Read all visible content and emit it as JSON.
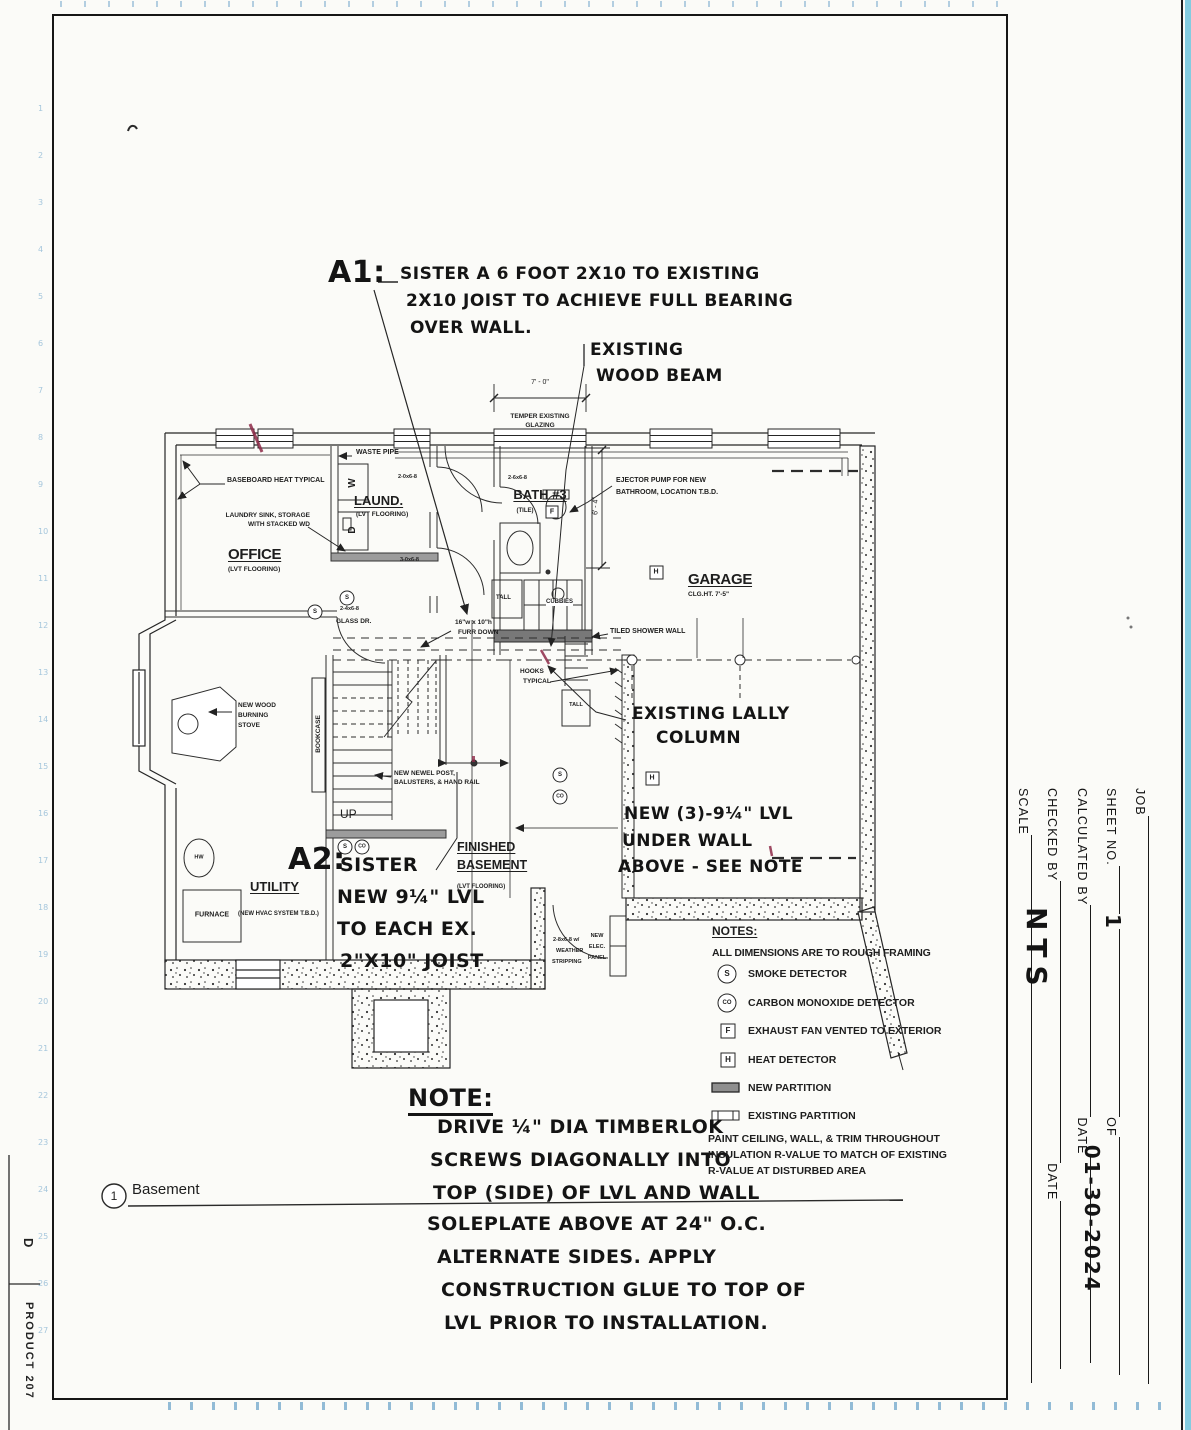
{
  "edge": {
    "letter": "D",
    "product": "PRODUCT 207"
  },
  "title_block": {
    "job": "JOB",
    "sheet_no": "SHEET NO.",
    "of": "OF",
    "calculated_by": "CALCULATED BY",
    "date": "DATE",
    "checked_by": "CHECKED BY",
    "date2": "DATE",
    "scale": "SCALE",
    "sheet_no_value": "1",
    "date_value": "01-30-2024",
    "scale_value": "NTS"
  },
  "footer": {
    "detail_number": "1",
    "title": "Basement"
  },
  "annotations": {
    "a1": {
      "label": "A1:",
      "lines": [
        "SISTER A 6 FOOT 2X10 TO EXISTING",
        "2X10 JOIST TO ACHIEVE FULL BEARING",
        "OVER WALL."
      ]
    },
    "wood_beam": [
      "EXISTING",
      "WOOD BEAM"
    ],
    "lally": [
      "EXISTING LALLY",
      "COLUMN"
    ],
    "new_lvl": [
      "NEW (3)-9¼\" LVL",
      "UNDER WALL",
      "ABOVE - SEE NOTE"
    ],
    "a2": {
      "label": "A2:",
      "lines": [
        "SISTER",
        "NEW 9¼\" LVL",
        "TO EACH EX.",
        "2\"X10\" JOIST"
      ]
    },
    "note": {
      "title": "NOTE:",
      "lines": [
        "DRIVE ¼\" DIA TIMBERLOK",
        "SCREWS DIAGONALLY INTO",
        "TOP (SIDE) OF LVL AND WALL",
        "SOLEPLATE ABOVE AT 24\" O.C.",
        "ALTERNATE SIDES. APPLY",
        "CONSTRUCTION GLUE TO TOP OF",
        "LVL PRIOR TO INSTALLATION."
      ]
    }
  },
  "rooms": {
    "office": {
      "name": "OFFICE",
      "sub": "(LVT FLOORING)"
    },
    "laundry": {
      "name": "LAUND.",
      "sub": "(LVT FLOORING)"
    },
    "bath": {
      "name": "BATH #3",
      "sub": "(TILE)"
    },
    "garage": {
      "name": "GARAGE",
      "sub": "CLG.HT. 7'-5\""
    },
    "utility": {
      "name": "UTILITY",
      "sub": "(NEW HVAC SYSTEM T.B.D.)"
    },
    "finished": {
      "name1": "FINISHED",
      "name2": "BASEMENT",
      "sub": "(LVT FLOORING)"
    }
  },
  "labels": {
    "baseboard": "BASEBOARD HEAT TYPICAL",
    "waste_pipe": "WASTE PIPE",
    "sink1": "LAUNDRY SINK, STORAGE",
    "sink2": "WITH STACKED WD",
    "temper1": "TEMPER EXISTING",
    "temper2": "GLAZING",
    "dim7": "7' - 0\"",
    "dim64": "6' - 4\"",
    "door_laund_top": "2-0x6-8",
    "door_laund_bot": "3-0x6-8",
    "door_bath": "2-6x6-8",
    "glass_size": "2-4x6-8",
    "glass": "GLASS DR.",
    "ejector1": "EJECTOR PUMP FOR NEW",
    "ejector2": "BATHROOM, LOCATION T.B.D.",
    "tiled": "TILED SHOWER WALL",
    "tall": "TALL",
    "cubbies": "CUBBIES",
    "tall2": "TALL",
    "hooks1": "HOOKS",
    "hooks2": "TYPICAL",
    "furr1": "16\"w x 10\"h",
    "furr2": "FURR DOWN",
    "bookcase": "BOOKCASE",
    "newel1": "NEW NEWEL POST,",
    "newel2": "BALUSTERS, & HAND RAIL",
    "up": "UP",
    "stove1": "NEW WOOD",
    "stove2": "BURNING",
    "stove3": "STOVE",
    "hw": "HW",
    "furnace": "FURNACE",
    "weather1": "2-8x6-8 w/",
    "weather2": "WEATHER",
    "weather3": "STRIPPING",
    "elec1": "NEW",
    "elec2": "ELEC.",
    "elec3": "PANEL",
    "washer": "W",
    "dryer": "D"
  },
  "notes": {
    "title": "NOTES:",
    "dims": "ALL DIMENSIONS ARE TO ROUGH FRAMING",
    "items": [
      {
        "sym": "S",
        "label": "SMOKE DETECTOR"
      },
      {
        "sym": "CO",
        "label": "CARBON MONOXIDE DETECTOR"
      },
      {
        "sym": "F",
        "label": "EXHAUST FAN VENTED TO EXTERIOR"
      },
      {
        "sym": "H",
        "label": "HEAT DETECTOR"
      },
      {
        "sym": "",
        "label": "NEW PARTITION"
      },
      {
        "sym": "",
        "label": "EXISTING PARTITION"
      }
    ],
    "paint": [
      "PAINT CEILING, WALL, & TRIM THROUGHOUT",
      "INSULATION R-VALUE TO MATCH OF EXISTING",
      "R-VALUE AT DISTURBED AREA"
    ]
  },
  "symbols": {
    "s": "S",
    "co": "CO",
    "f": "F",
    "h": "H"
  },
  "colors": {
    "ink": "#1e1e1e",
    "red_mark": "#8e2a48",
    "margin_blue": "#7fb0d0",
    "band_blue": "#6ec3dc",
    "new_partition_gray": "#9c9c9c"
  }
}
